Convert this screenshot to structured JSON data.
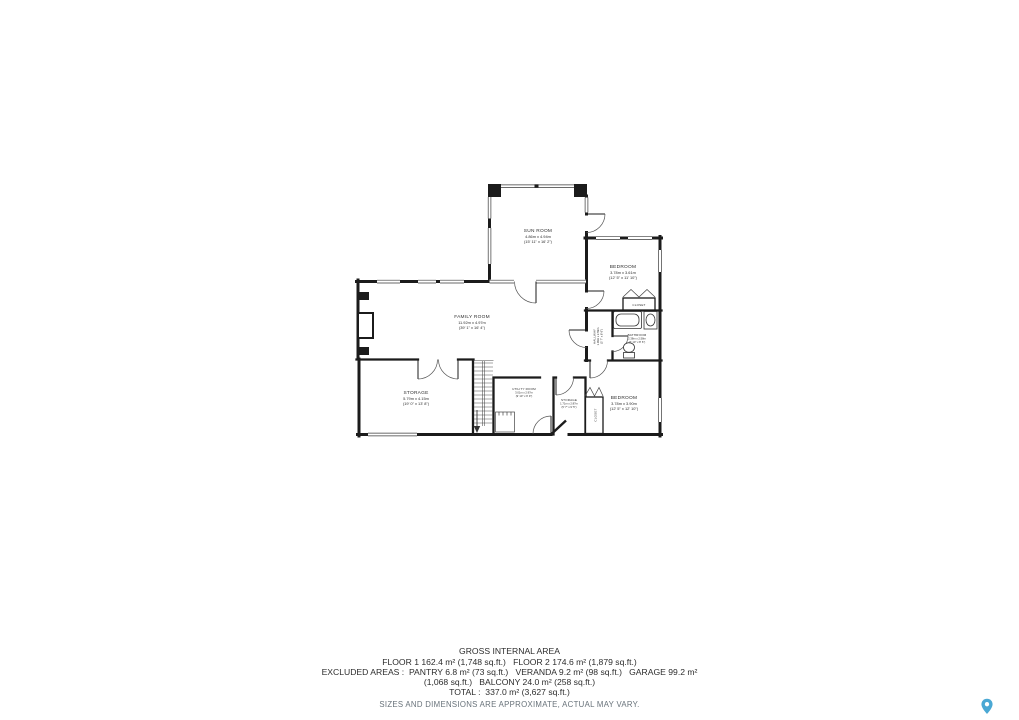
{
  "floorplan": {
    "rooms": {
      "sun_room": {
        "name": "SUN ROOM",
        "metric": "4.86m x 4.94m",
        "imperial": "(15' 11\" x 16' 2\")"
      },
      "bedroom_upper": {
        "name": "BEDROOM",
        "metric": "3.78m x 3.61m",
        "imperial": "(12' 5\" x 11' 10\")"
      },
      "family_room": {
        "name": "FAMILY ROOM",
        "metric": "11.92m x 4.97m",
        "imperial": "(39' 1\" x 16' 4\")"
      },
      "bathroom": {
        "name": "BATHROOM",
        "metric": "2.38m x 2.58m",
        "imperial": "(7' 10\" x 8' 6\")"
      },
      "hallway": {
        "name": "HALLWAY",
        "metric": "1.09m x 2.59m",
        "imperial": "(3' 7\" x 8' 6\")"
      },
      "storage_main": {
        "name": "STORAGE",
        "metric": "5.79m x 4.15m",
        "imperial": "(19' 0\" x 13' 8\")"
      },
      "utility_room": {
        "name": "UTILITY ROOM",
        "metric": "3.01m x 2.97m",
        "imperial": "(9' 10\" x 9' 9\")"
      },
      "storage_small": {
        "name": "STORAGE",
        "metric": "1.71m x 2.87m",
        "imperial": "(5' 7\" x 9' 5\")"
      },
      "closet_upper": {
        "name": "CLOSET"
      },
      "closet_lower": {
        "name": "CLOSET"
      },
      "bedroom_lower": {
        "name": "BEDROOM",
        "metric": "3.78m x 3.90m",
        "imperial": "(12' 5\" x 12' 10\")"
      }
    }
  },
  "footer": {
    "title": "GROSS INTERNAL AREA",
    "line1": "FLOOR 1 162.4 m² (1,748 sq.ft.)   FLOOR 2 174.6 m² (1,879 sq.ft.)",
    "line2": "EXCLUDED AREAS :  PANTRY 6.8 m² (73 sq.ft.)   VERANDA 9.2 m² (98 sq.ft.)   GARAGE 99.2 m²",
    "line3": "(1,068 sq.ft.)   BALCONY 24.0 m² (258 sq.ft.)",
    "line4": "TOTAL :  337.0 m² (3,627 sq.ft.)",
    "disclaimer": "SIZES AND DIMENSIONS ARE APPROXIMATE, ACTUAL MAY VARY."
  },
  "colors": {
    "wall": "#1b1b1b",
    "label_text": "#2e2e2e",
    "footer_text": "#2d2d2d",
    "disclaimer_text": "#68727a",
    "pin_blue": "#4aa8d4",
    "background": "#ffffff"
  }
}
